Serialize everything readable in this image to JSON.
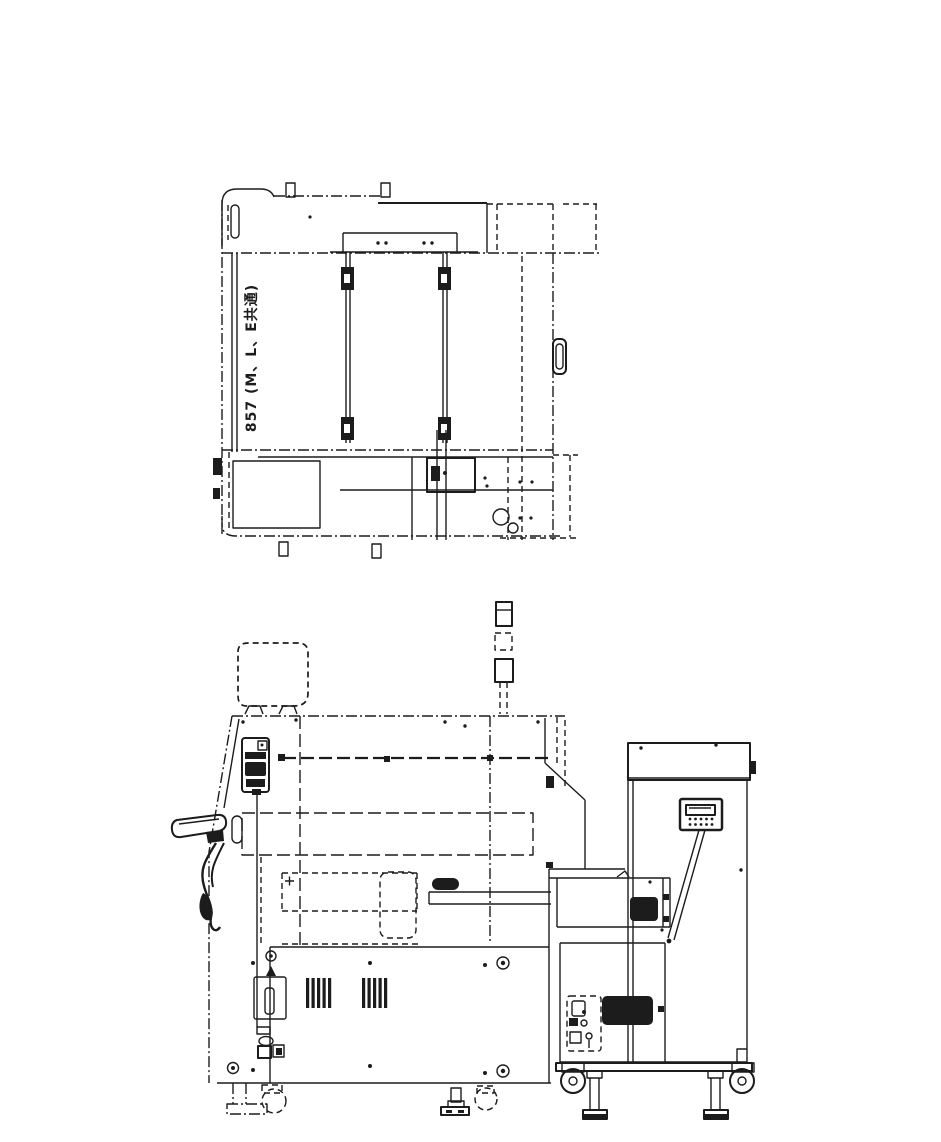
{
  "page": {
    "width": 941,
    "height": 1142,
    "background_color": "#ffffff",
    "ink_color": "#1c1c1c"
  },
  "drawing": {
    "plan_view": {
      "name": "machine-top-plan-view",
      "dimension_label": "857 (M、L、E共通)"
    },
    "side_view": {
      "name": "machine-side-elevation-view",
      "components": [
        "crt-monitor",
        "signal-tower",
        "machine-body",
        "feeder-motor",
        "operator-handle",
        "base-panel",
        "vent-grille-left",
        "vent-grille-right",
        "interlock-plate",
        "power-connectors",
        "leveling-feet",
        "casters",
        "connecting-rail",
        "feeder-cart",
        "keypad-pendant",
        "pendant-arm",
        "cart-control-panel",
        "cart-vent-grille"
      ]
    }
  }
}
